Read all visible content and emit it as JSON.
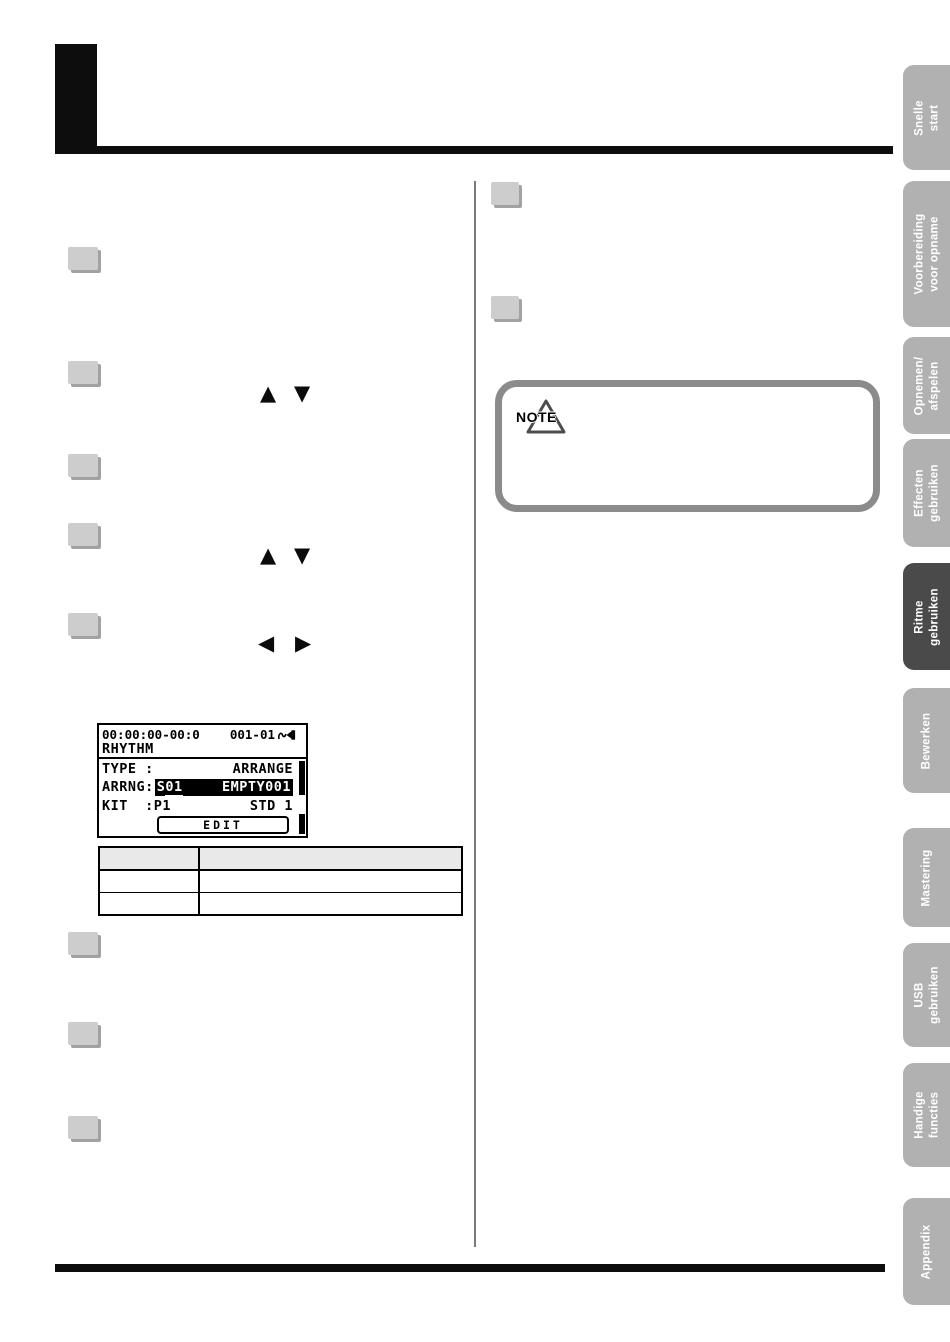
{
  "sidebar": {
    "tabs": [
      {
        "label": "Snelle start",
        "active": false
      },
      {
        "label": "Voorbereiding\nvoor opname",
        "active": false
      },
      {
        "label": "Opnemen/\nafspelen",
        "active": false
      },
      {
        "label": "Effecten\ngebruiken",
        "active": false
      },
      {
        "label": "Ritme\ngebruiken",
        "active": true
      },
      {
        "label": "Bewerken",
        "active": false
      },
      {
        "label": "Mastering",
        "active": false
      },
      {
        "label": "USB\ngebruiken",
        "active": false
      },
      {
        "label": "Handige\nfuncties",
        "active": false
      },
      {
        "label": "Appendix",
        "active": false
      }
    ]
  },
  "lcd": {
    "status_time": "00:00:00-00:0",
    "status_pos": "001-01",
    "power_icon": "ac-adapter-icon",
    "title": "RHYTHM",
    "type_label": "TYPE :",
    "type_value": "ARRANGE",
    "arrng_label": "ARRNG:",
    "arrng_prefix": "S",
    "arrng_num": "01",
    "arrng_name": "EMPTY001",
    "kit_label": "KIT  :",
    "kit_value": "P1",
    "kit_name": "STD 1",
    "edit_label": "EDIT"
  },
  "table": {
    "headers": [
      "",
      ""
    ],
    "rows": [
      [
        "",
        ""
      ],
      [
        "",
        ""
      ]
    ]
  },
  "note": {
    "label": "NOTE"
  },
  "icons": {
    "cursor_up": "▲",
    "cursor_down": "▼",
    "cursor_left": "◀",
    "cursor_right": "▶"
  },
  "colors": {
    "tab_inactive": "#b1b1b1",
    "tab_active": "#4a4a4a",
    "note_border": "#8b8b8b",
    "accent_black": "#0d0d0d",
    "table_header_bg": "#e9e9e9"
  }
}
